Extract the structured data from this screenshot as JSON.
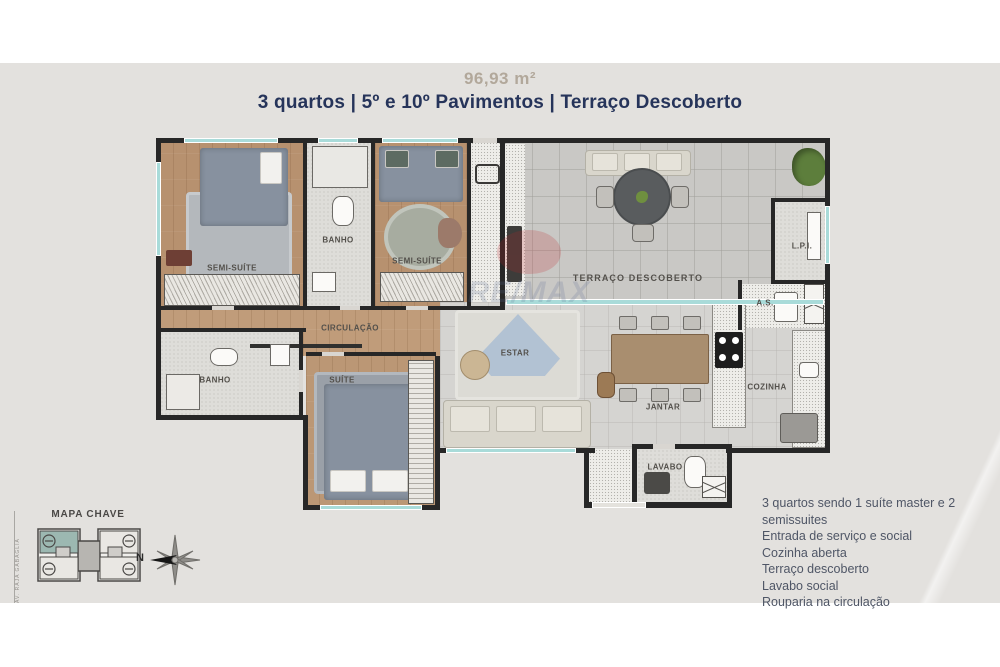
{
  "header": {
    "area": "96,93 m²",
    "subtitle": "3 quartos | 5º e 10º Pavimentos | Terraço Descoberto"
  },
  "plan": {
    "watermark": "RE/MAX",
    "rooms": [
      {
        "id": "semi-suite-1",
        "label": "SEMI-SUÍTE"
      },
      {
        "id": "banho-1",
        "label": "BANHO"
      },
      {
        "id": "semi-suite-2",
        "label": "SEMI-SUÍTE"
      },
      {
        "id": "circulacao",
        "label": "CIRCULAÇÃO"
      },
      {
        "id": "banho-2",
        "label": "BANHO"
      },
      {
        "id": "suite",
        "label": "SUÍTE"
      },
      {
        "id": "terraco-descoberto",
        "label": "TERRAÇO DESCOBERTO"
      },
      {
        "id": "estar",
        "label": "ESTAR"
      },
      {
        "id": "jantar",
        "label": "JANTAR"
      },
      {
        "id": "cozinha",
        "label": "COZINHA"
      },
      {
        "id": "lavabo",
        "label": "LAVABO"
      },
      {
        "id": "area-servico",
        "label": "A.S."
      },
      {
        "id": "lpi",
        "label": "L.P.I."
      }
    ]
  },
  "key_map": {
    "title": "MAPA CHAVE",
    "street": "AV. RAJA GABAGLIA",
    "compass_label": "N"
  },
  "features": {
    "items": [
      "3 quartos sendo 1 suíte master e 2 semissuites",
      "Entrada de serviço e social",
      "Cozinha aberta",
      "Terraço descoberto",
      "Lavabo social",
      "Rouparia na circulação"
    ]
  },
  "colors": {
    "accent_navy": "#26345a",
    "accent_tan": "#b2a89b",
    "wall": "#272727",
    "window_teal": "#a9dbd9",
    "keymap_highlight": "#9cb8b1"
  }
}
